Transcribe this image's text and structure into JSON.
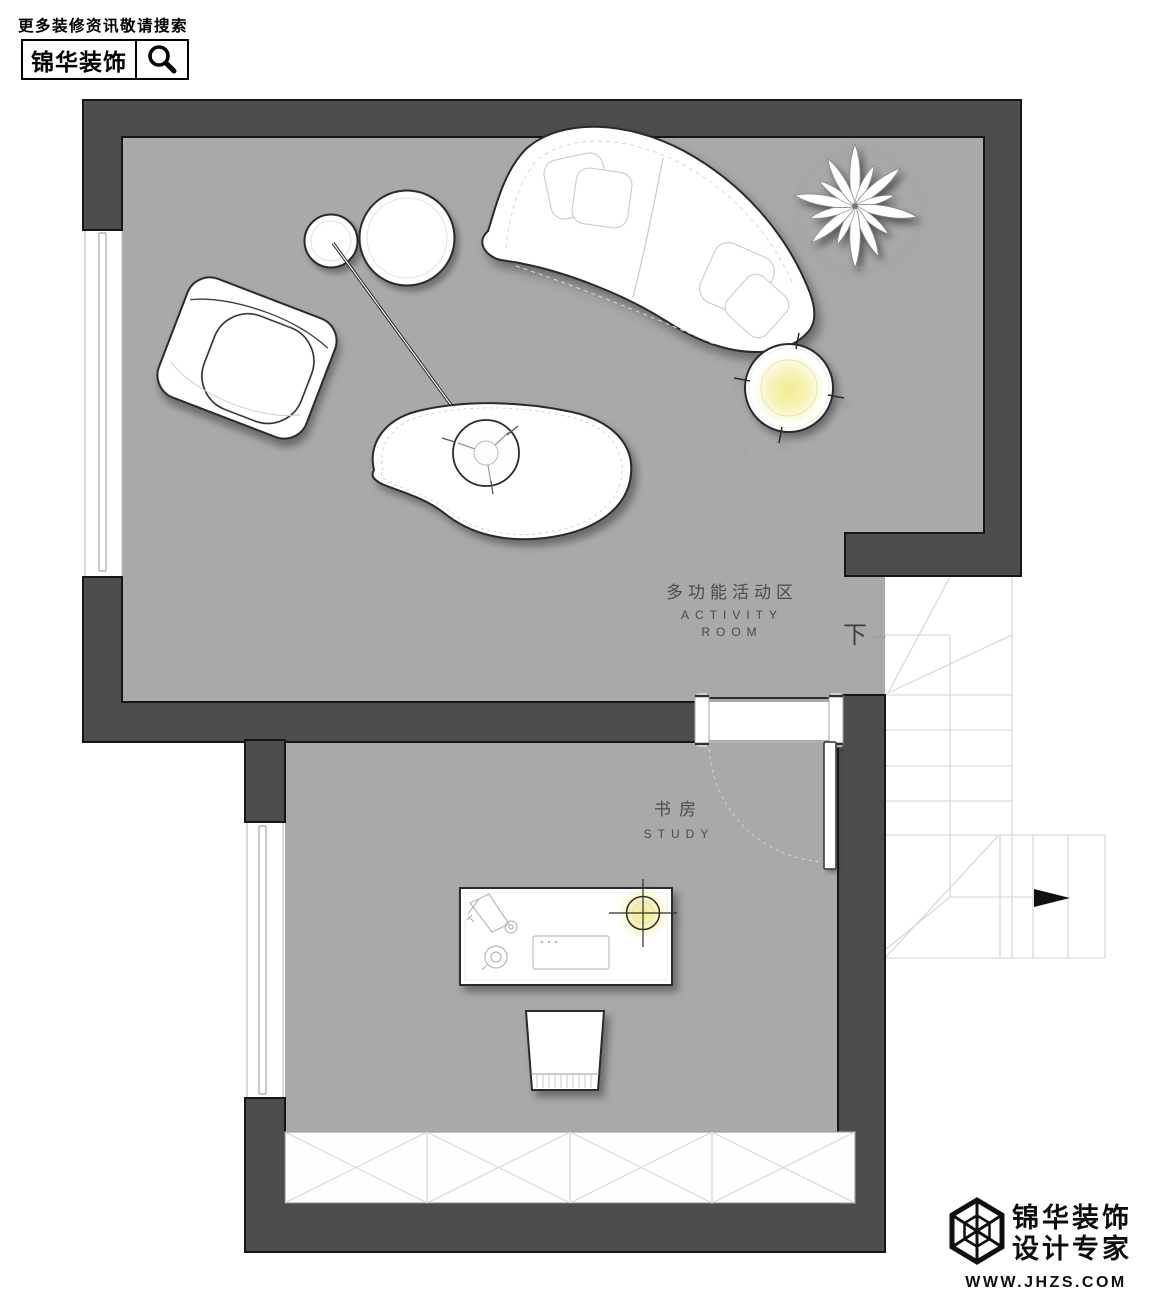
{
  "header": {
    "tagline": "更多装修资讯敬请搜索",
    "brand": "锦华装饰"
  },
  "rooms": {
    "activity": {
      "name_zh": "多功能活动区",
      "name_en_line1": "ACTIVITY",
      "name_en_line2": "ROOM"
    },
    "study": {
      "name_zh": "书房",
      "name_en": "STUDY"
    }
  },
  "stairs": {
    "down_label": "下"
  },
  "watermark": {
    "brand_line1": "锦华装饰",
    "brand_line2": "设计专家",
    "website": "WWW.JHZS.COM"
  },
  "colors": {
    "wall": "#4d4d4d",
    "floor": "#a9a9a9",
    "lamp_glow": "#f2ec8e",
    "stair_line": "#d9d9d9"
  }
}
